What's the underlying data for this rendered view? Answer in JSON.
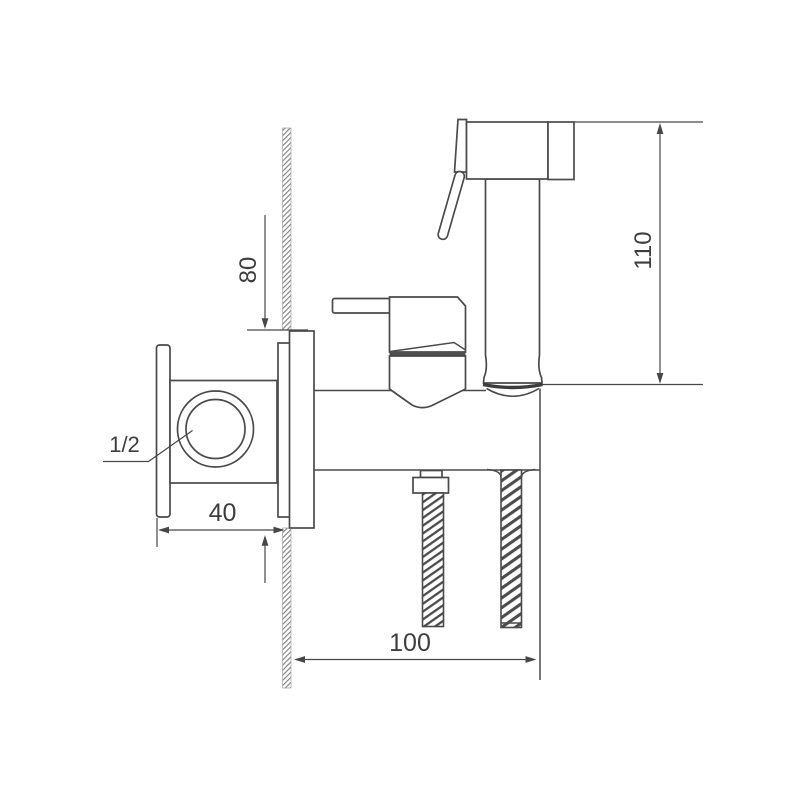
{
  "drawing": {
    "colors": {
      "background": "#ffffff",
      "line": "#4a4a4a",
      "hatch": "#848484"
    },
    "dimensions": {
      "sprayer_height": "110",
      "plate_height": "80",
      "plate_width": "40",
      "body_depth": "100",
      "thread_size": "1/2"
    }
  }
}
